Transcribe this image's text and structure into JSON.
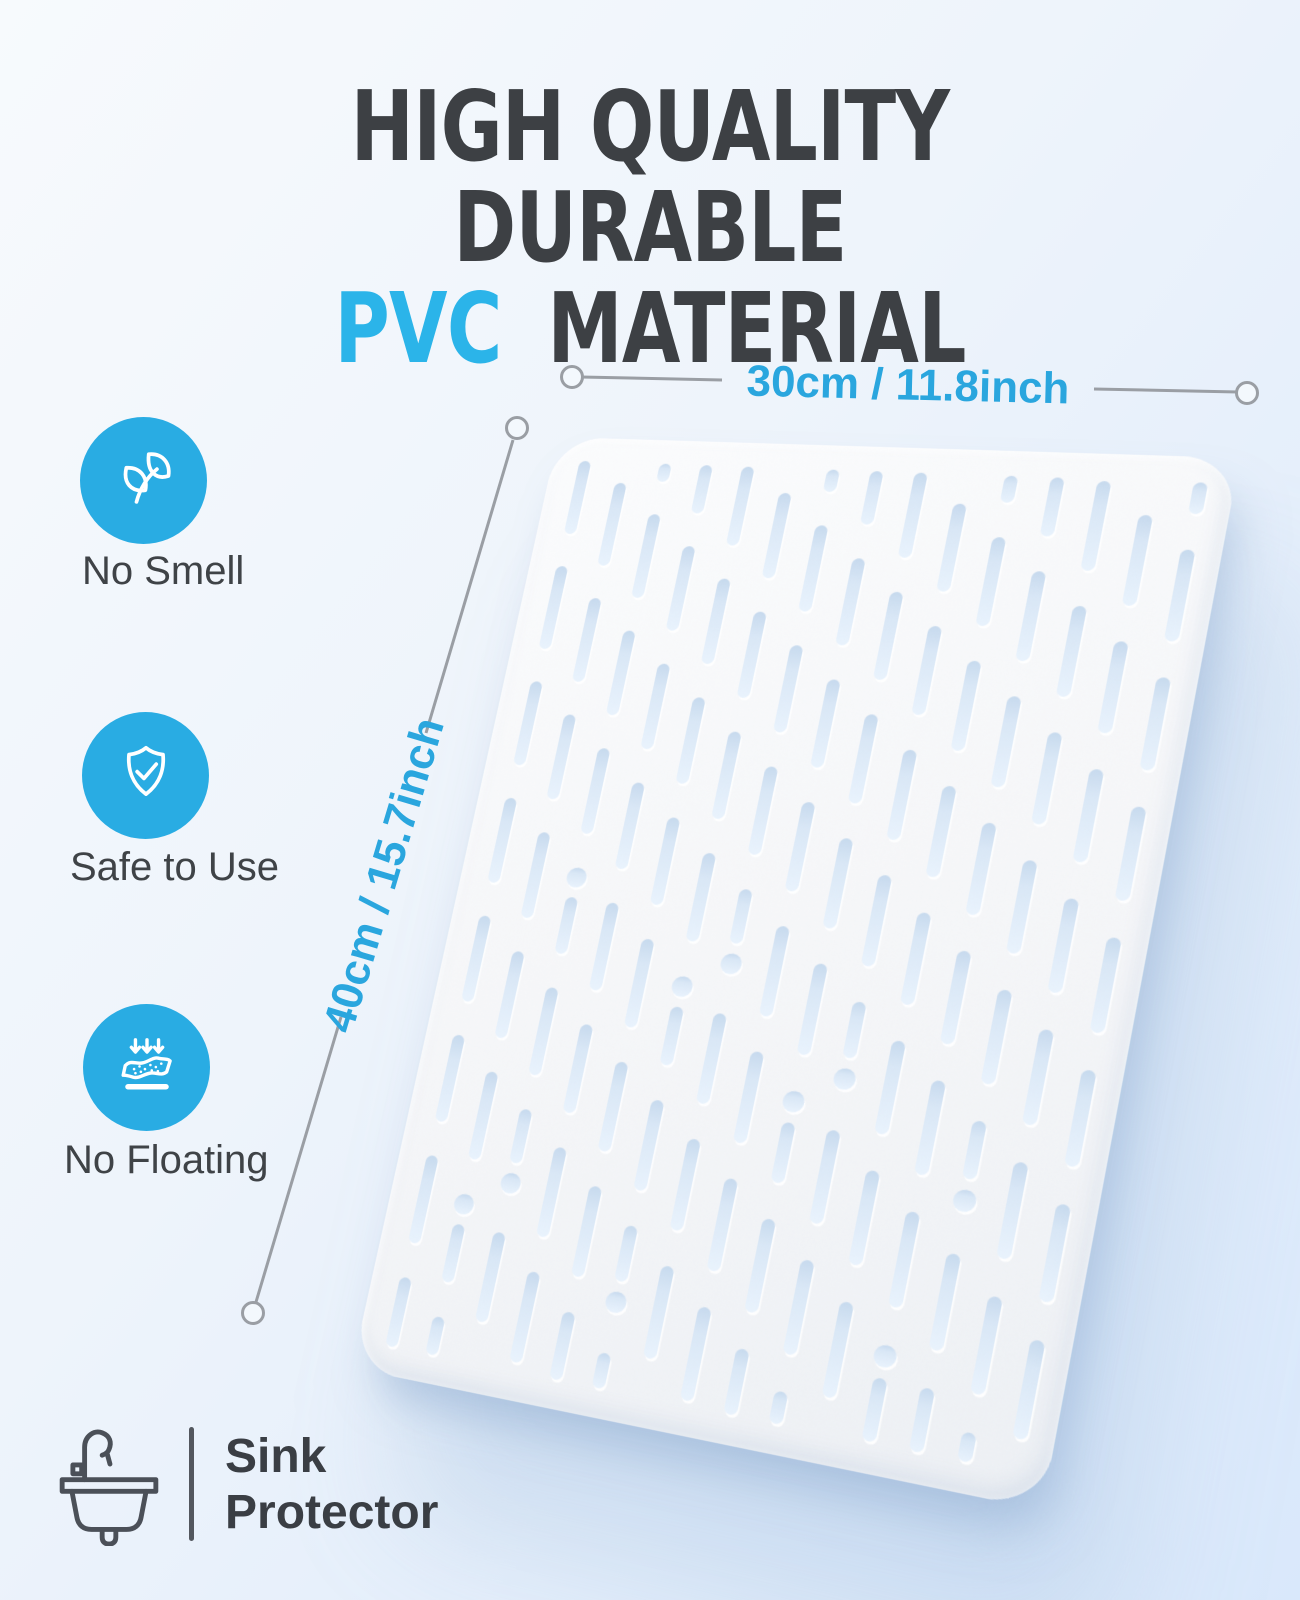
{
  "title": {
    "line1": "HIGH QUALITY DURABLE",
    "line2_accent": "PVC",
    "line2_rest": "MATERIAL"
  },
  "features": [
    {
      "icon": "leaf-icon",
      "label": "No Smell"
    },
    {
      "icon": "shield-check-icon",
      "label": "Safe to Use"
    },
    {
      "icon": "no-floating-icon",
      "label": "No Floating"
    }
  ],
  "dimensions": {
    "width": "30cm / 11.8inch",
    "height": "40cm / 15.7inch"
  },
  "product": {
    "icon": "sink-icon",
    "name_line1": "Sink",
    "name_line2": "Protector"
  },
  "colors": {
    "accent_blue": "#29ace3",
    "pvc_blue": "#2bb4e9",
    "dimension_blue": "#2aa6de",
    "title_dark": "#3d4044",
    "line_gray": "#9a9ea4",
    "mat_base": "#f6f7f9",
    "slot_fill": "#dcebfb"
  }
}
